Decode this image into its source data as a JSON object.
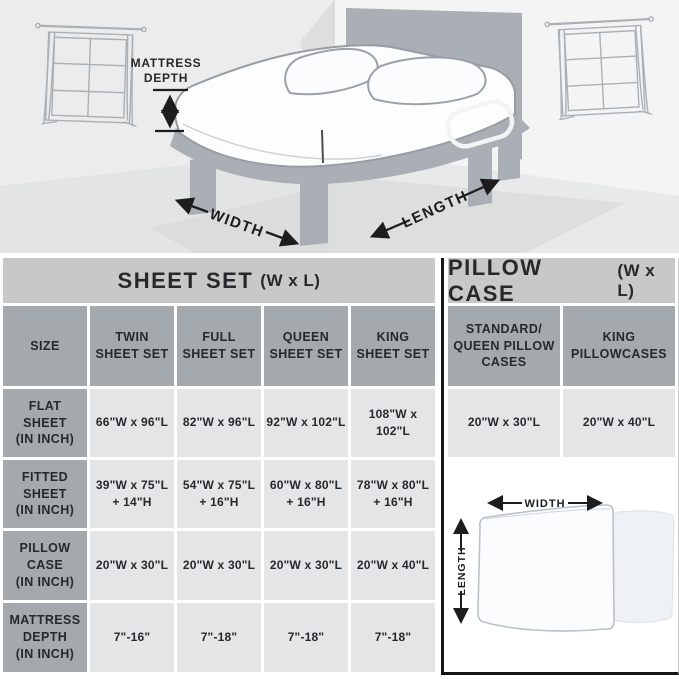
{
  "scene": {
    "labels": {
      "mattress_depth": "MATTRESS\nDEPTH",
      "width": "WIDTH",
      "length": "LENGTH"
    }
  },
  "sheet_table": {
    "title": "SHEET SET",
    "title_suffix": "(W x L)",
    "columns": [
      "SIZE",
      "TWIN\nSHEET SET",
      "FULL\nSHEET SET",
      "QUEEN\nSHEET SET",
      "KING\nSHEET SET"
    ],
    "rows": [
      {
        "label": "FLAT\nSHEET\n(IN INCH)",
        "values": [
          "66\"W x 96\"L",
          "82\"W x 96\"L",
          "92\"W x 102\"L",
          "108\"W x 102\"L"
        ]
      },
      {
        "label": "FITTED\nSHEET\n(IN INCH)",
        "values": [
          "39\"W x 75\"L\n+ 14\"H",
          "54\"W x 75\"L\n+ 16\"H",
          "60\"W x 80\"L\n+ 16\"H",
          "78\"W x 80\"L\n+ 16\"H"
        ]
      },
      {
        "label": "PILLOW\nCASE\n(IN INCH)",
        "values": [
          "20\"W x 30\"L",
          "20\"W x 30\"L",
          "20\"W x 30\"L",
          "20\"W x 40\"L"
        ]
      },
      {
        "label": "MATTRESS\nDEPTH\n(IN INCH)",
        "values": [
          "7\"-16\"",
          "7\"-18\"",
          "7\"-18\"",
          "7\"-18\""
        ]
      }
    ]
  },
  "pillow_table": {
    "title": "PILLOW CASE",
    "title_suffix": "(W x L)",
    "columns": [
      "STANDARD/\nQUEEN PILLOW\nCASES",
      "KING\nPILLOWCASES"
    ],
    "values": [
      "20\"W x 30\"L",
      "20\"W x 40\"L"
    ],
    "diagram_labels": {
      "width": "WIDTH",
      "length": "LENGTH"
    }
  },
  "colors": {
    "title_bar_bg": "#c7c9c8",
    "header_bg": "#a3a9ad",
    "cell_bg": "#e3e5e6",
    "text": "#26292b",
    "panel_border": "#161616",
    "bed_frame_gray": "#a9afb4",
    "wall_gray": "#ececec",
    "floor_gray": "#e3e4e4"
  }
}
